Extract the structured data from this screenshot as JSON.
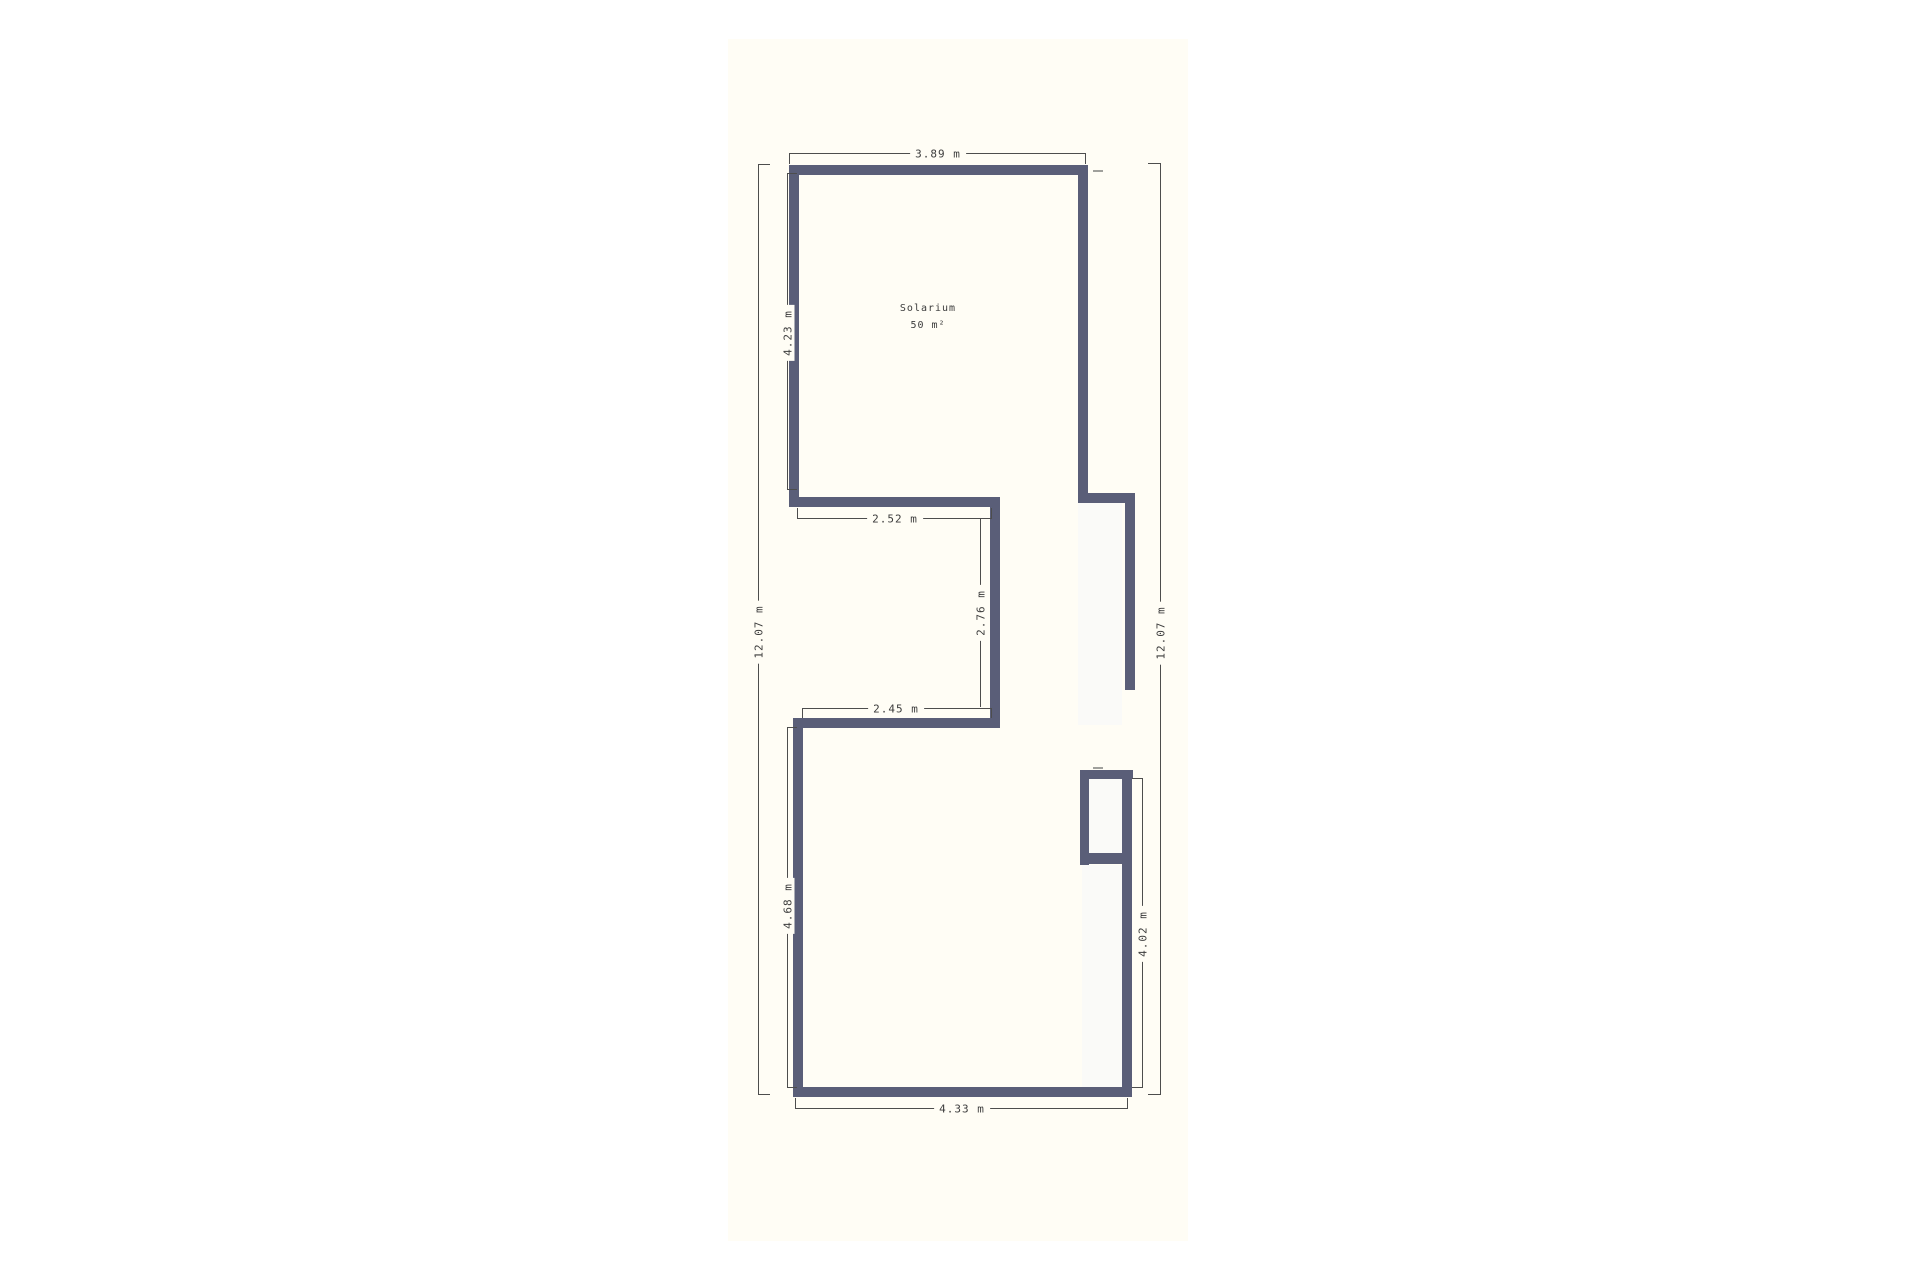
{
  "plan": {
    "room": {
      "label": "Solarium",
      "area": "50 m²"
    },
    "dimensions": {
      "top": "3.89 m",
      "left_outer": "12.07 m",
      "left_inner": "4.23 m",
      "notch_top": "2.52 m",
      "notch_vertical": "2.76 m",
      "notch_bottom": "2.45 m",
      "lower_left": "4.68 m",
      "lower_right": "4.02 m",
      "right_outer": "12.07 m",
      "bottom": "4.33 m"
    },
    "colors": {
      "wall": "#5a5e78",
      "paper": "#fffdf5",
      "strip": "#fafaf8",
      "dim_line": "#4d4d4d",
      "text": "#3c3c3c",
      "tick": "#a0a09c"
    }
  }
}
